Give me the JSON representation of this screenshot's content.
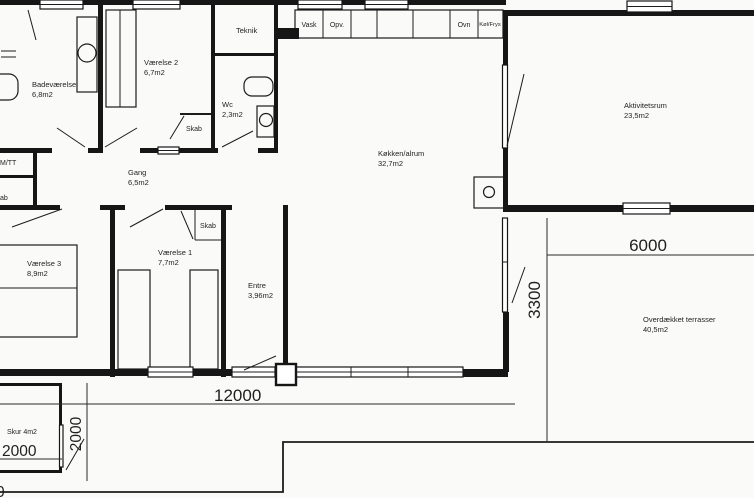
{
  "rooms": {
    "badevaerelse": {
      "name": "Badeværelse",
      "area": "6,8m2"
    },
    "vaerelse2": {
      "name": "Værelse 2",
      "area": "6,7m2"
    },
    "teknik": {
      "name": "Teknik"
    },
    "wc": {
      "name": "Wc",
      "area": "2,3m2"
    },
    "gang": {
      "name": "Gang",
      "area": "6,5m2"
    },
    "vaerelse3": {
      "name": "Værelse 3",
      "area": "8,9m2"
    },
    "vaerelse1": {
      "name": "Værelse 1",
      "area": "7,7m2"
    },
    "entre": {
      "name": "Entre",
      "area": "3,96m2"
    },
    "koekken": {
      "name": "Køkken/alrum",
      "area": "32,7m2"
    },
    "aktivitetsrum": {
      "name": "Aktivitetsrum",
      "area": "23,5m2"
    },
    "terrasse": {
      "name": "Overdækket terrasser",
      "area": "40,5m2"
    },
    "skur": {
      "name": "Skur 4m2"
    }
  },
  "closets": {
    "skab_vaerelse2": "Skab",
    "skab_vaerelse1": "Skab"
  },
  "appliances": {
    "vask": "Vask",
    "opvaskemaskine": "Opv.",
    "ovn": "Ovn",
    "koel_frys": "Køl/Frys"
  },
  "utility": {
    "laundry_cut": "M/TT",
    "closet_cut": "ab"
  },
  "dimensions": {
    "house_width": "12000",
    "terrace_width": "6000",
    "terrace_depth": "3300",
    "skur_width": "2000",
    "skur_depth": "2000",
    "cut_digit": "0"
  }
}
